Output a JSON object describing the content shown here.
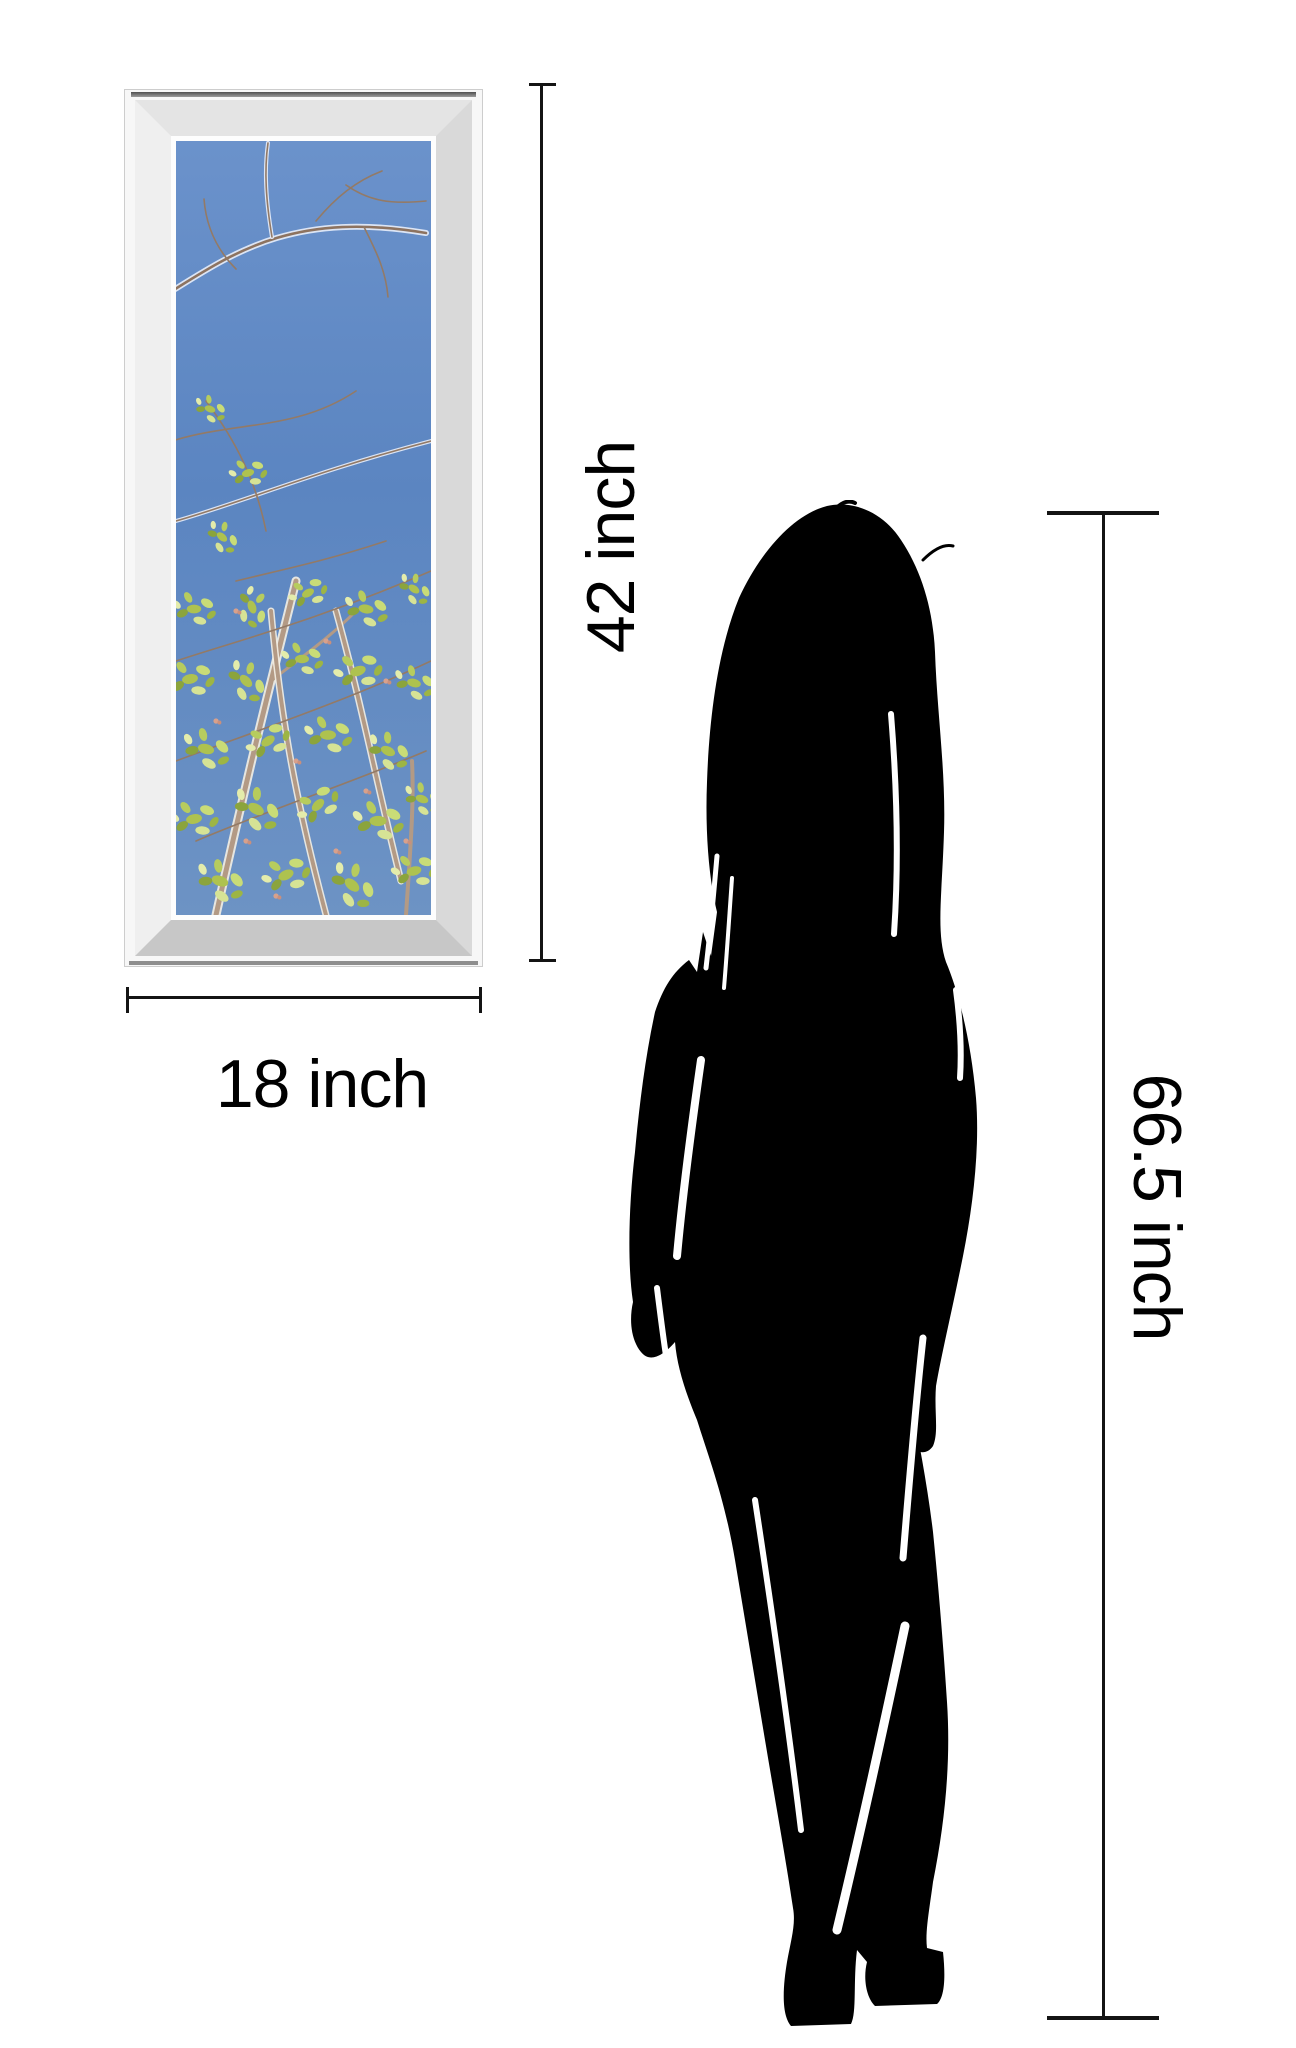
{
  "dimension_labels": {
    "frame_height": "42 inch",
    "frame_width": "18 inch",
    "person_height": "66.5 inch"
  },
  "colors": {
    "background": "#ffffff",
    "dimension_line": "#141414",
    "label_text": "#000000",
    "silhouette": "#000000",
    "sky_blue": "#5b85c1",
    "leaf_green": "#aec24f",
    "branch_brown": "#8d7360",
    "frame_silver_light": "#e4e4e4",
    "frame_silver_dark": "#c7c7c7"
  },
  "artwork": {
    "alt": "Spring tree branches with budding green leaves against a blue sky"
  }
}
